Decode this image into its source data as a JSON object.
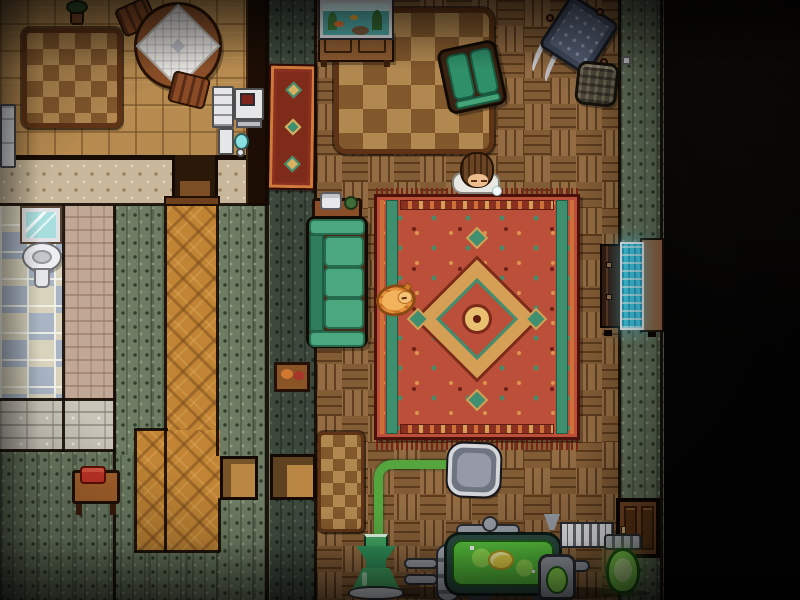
{
  "scene": {
    "description": "Top-down pixel-art home interior at night; lit rooms on the left, pitch-black outdoors on the right",
    "rooms": [
      {
        "name": "dining-room",
        "position": "top-left",
        "floor": "tan wood tile"
      },
      {
        "name": "bathroom",
        "position": "mid-left",
        "floor": "blue and cream checker tile"
      },
      {
        "name": "hallway",
        "position": "bottom-left",
        "floor": "orange diamond parquet"
      },
      {
        "name": "living-room",
        "position": "center",
        "floor": "brown basket-weave parquet"
      },
      {
        "name": "outside",
        "position": "right",
        "floor": "darkness"
      }
    ],
    "entities": {
      "dining_table": "round dining table with white tablecloth",
      "dining_chair": "wooden chair",
      "dining_rug": "brown checkered rug",
      "potted_plant": "potted plant",
      "white_cabinet": "white cabinet with monitor",
      "water_cooler": "water dispenser",
      "refrigerator": "refrigerator",
      "bathroom_mirror": "bathroom mirror",
      "bathroom_sink": "pedestal sink",
      "phone_table": "telephone table with red phone",
      "runner_rug": "ornate red runner rug",
      "crate": "wooden crate",
      "aquarium": "aquarium on wooden cabinet",
      "living_rug_brown": "brown checkered rug",
      "armchair": "green armchair",
      "rocking_chair": "rocking chair with studded cushion",
      "basket": "woven yarn basket",
      "persian_rug": "large red persian rug with medallion",
      "couch": "green three-seat couch",
      "side_table": "side table with telephone",
      "television": "television with glowing blue screen",
      "east_door": "wooden door",
      "alcove_passage": "doorway passage",
      "floor_pad": "grey floor pad",
      "green_cable": "green cable",
      "machine": "makeshift machine with glowing green tank",
      "flask": "green glass flask",
      "grow_bulb": "glowing green bulb",
      "door_mat": "small brown mat",
      "child": "dozing child with brown hair and white collar",
      "cat": "orange cat curled asleep on rug edge"
    },
    "characters": [
      {
        "name": "child",
        "state": "dozing upright with drool bubble",
        "location": "living-room"
      },
      {
        "name": "cat",
        "state": "curled up sleeping",
        "location": "persian rug edge"
      }
    ]
  },
  "palette": {
    "outside": "#030303",
    "dining_floor": "#b78b50",
    "parquet": "#8d6439",
    "diamond_floor": "#c08434",
    "wall_green": "#6d7c63",
    "wall_green_dark": "#515f50",
    "wall_beige": "#c8b79a",
    "wall_pink": "#c0a796",
    "wall_grey": "#c9c5b9",
    "tile_blue": "#a9b5c5",
    "tile_cream": "#d9d3bd",
    "wall_dark": "#1c0e04",
    "rug_red": "#bc4f3a",
    "rug_red_dark": "#7e2b1a",
    "rug_teal": "#3f8f6e",
    "rug_orange": "#cf7038",
    "rug_tan": "#d5a055",
    "rug_brown": "#aa7f47",
    "couch_green": "#4aa77e",
    "wood_dark": "#452a16",
    "wood_mid": "#8a5a30",
    "tv_screen": "#3fd0ec",
    "metal": "#9aa0a8",
    "metal_dark": "#2a2d33",
    "liquid_green": "#57c23d",
    "liquid_yellow": "#ecd94a",
    "glow_green": "#86df52",
    "cat_orange": "#e6913c",
    "hair_brown": "#6b4424",
    "skin": "#ecbd8e",
    "pad_grey": "#6e7480"
  }
}
